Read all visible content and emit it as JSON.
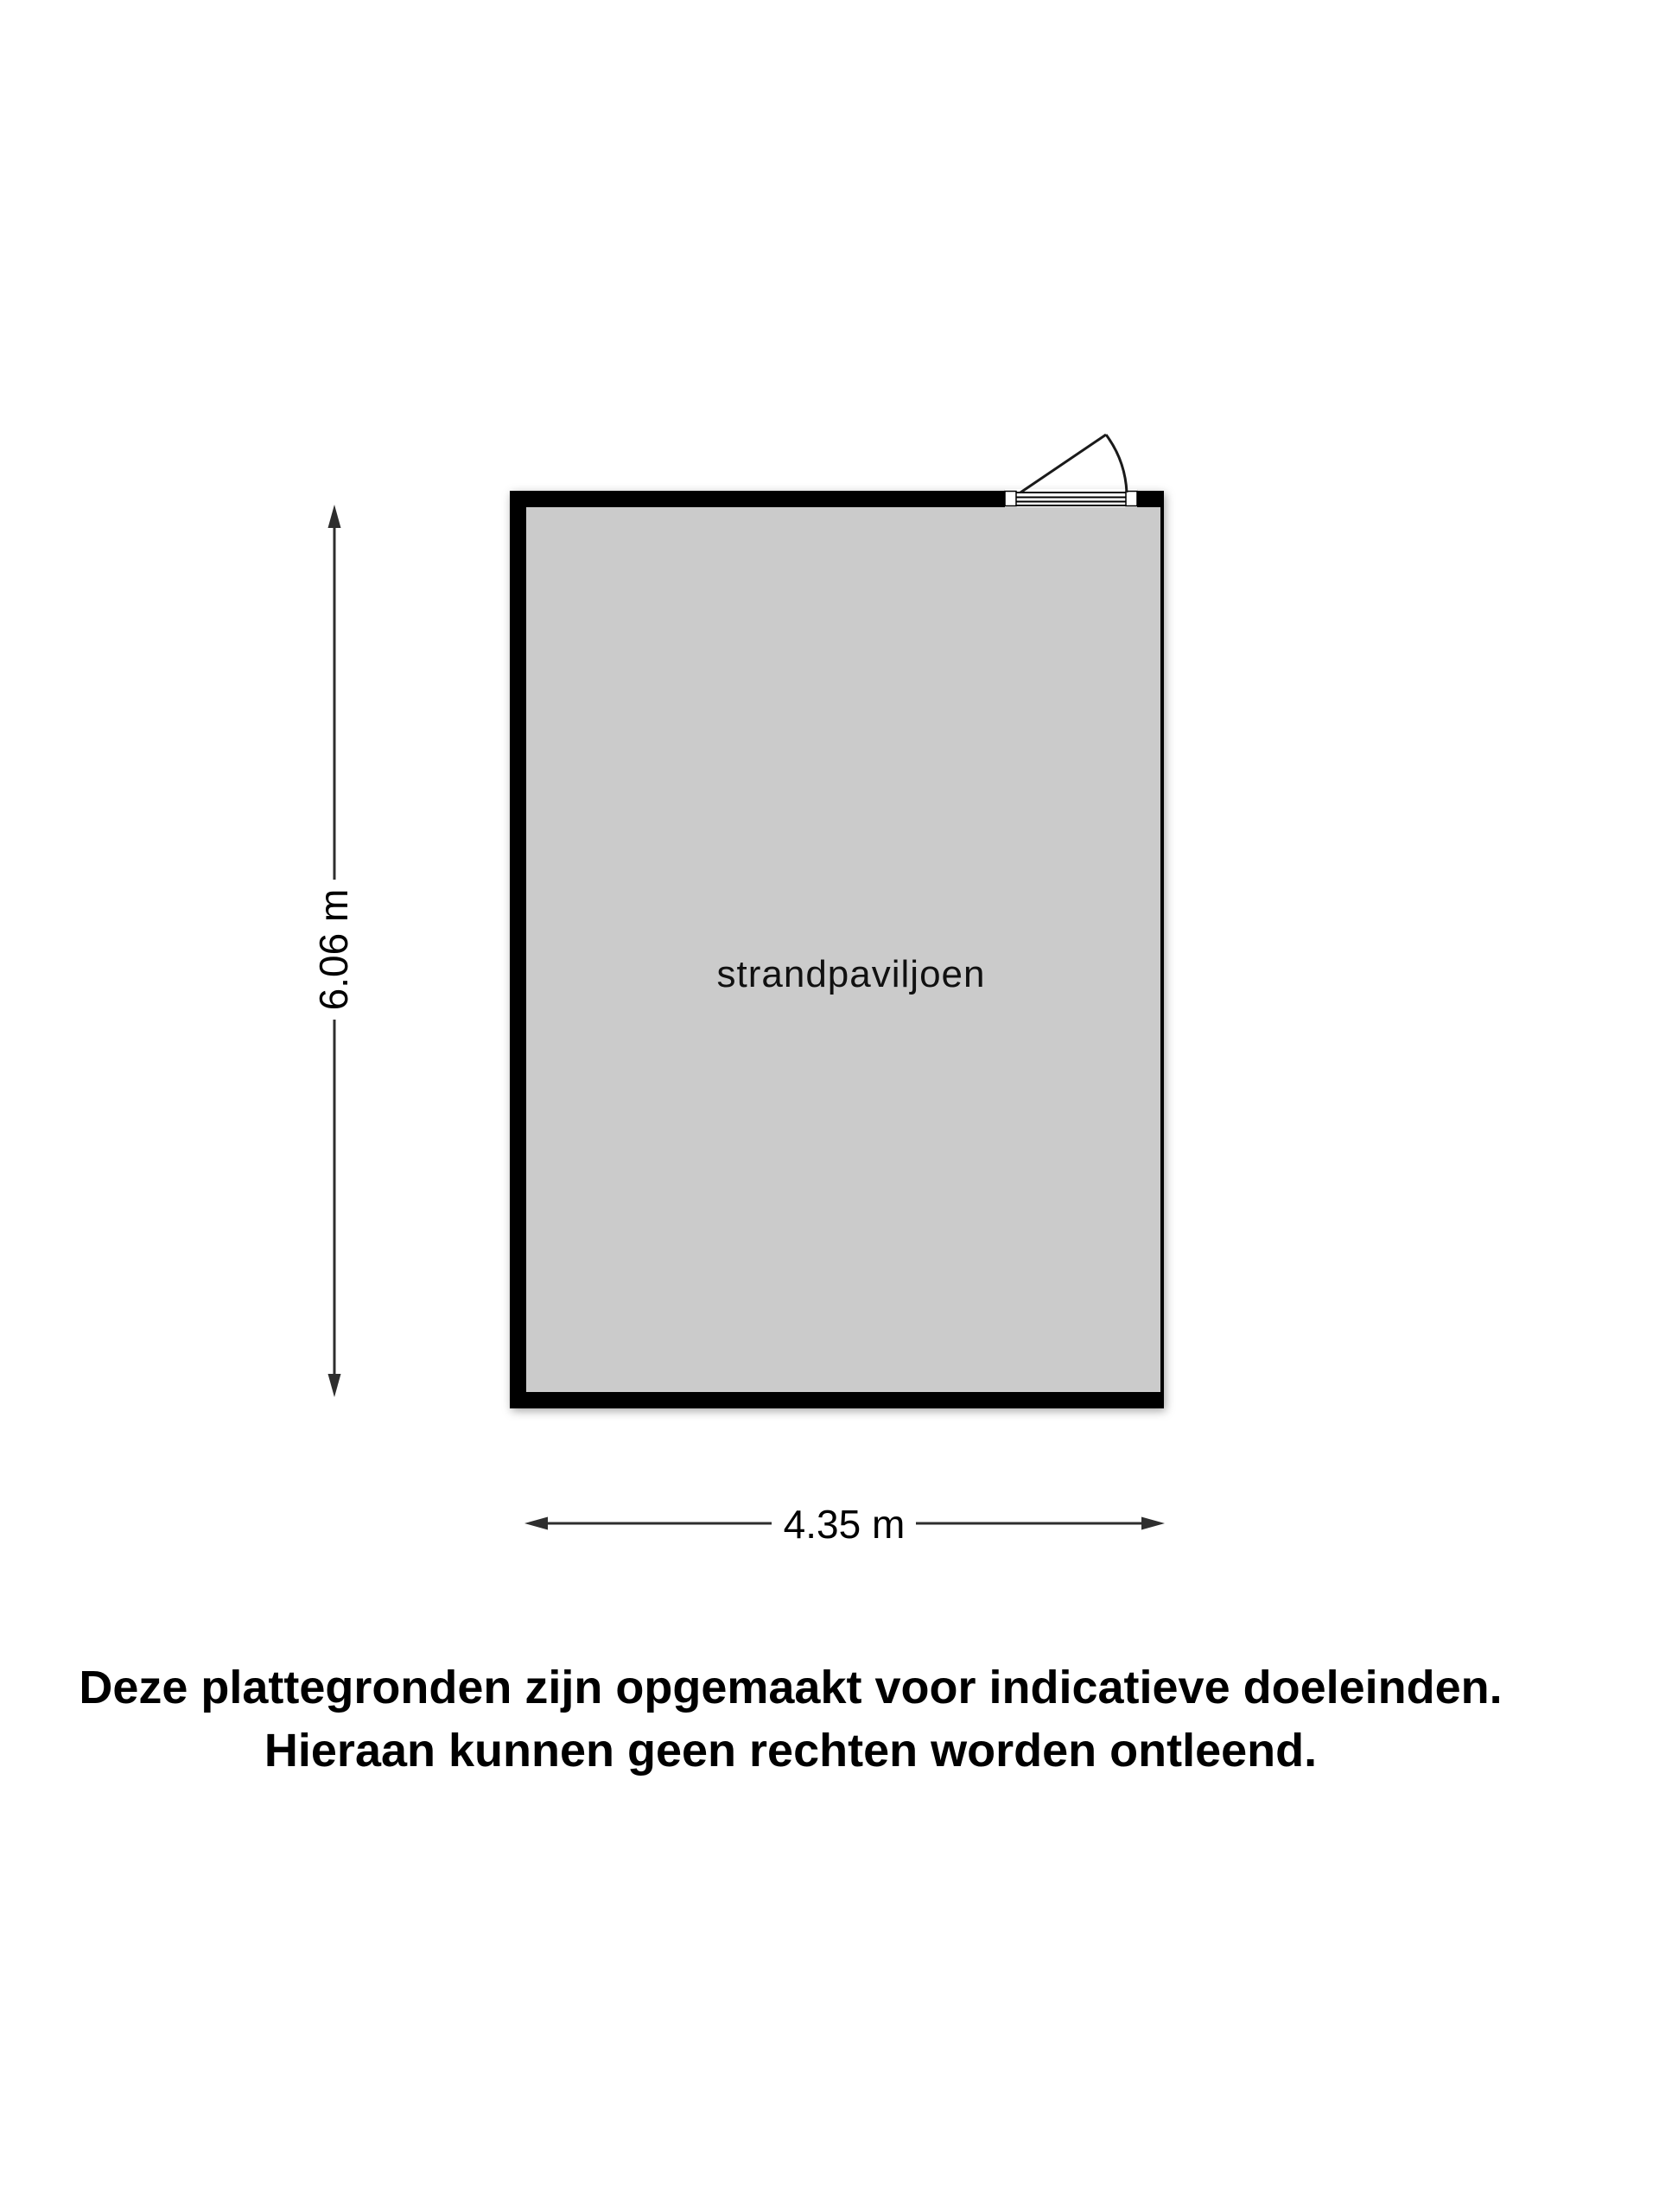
{
  "floor_plan": {
    "room": {
      "label": "strandpaviljoen"
    },
    "dimensions": {
      "height_label": "6.06 m",
      "width_label": "4.35 m"
    },
    "door": {
      "wall": "top",
      "hinge_side": "left",
      "swing": "outward"
    },
    "colors": {
      "background": "#ffffff",
      "room_fill": "#cbcbcb",
      "wall": "#000000",
      "dimension_line": "#2e2e2e",
      "text": "#000000"
    }
  },
  "disclaimer": {
    "line1": "Deze plattegronden zijn opgemaakt voor indicatieve doeleinden.",
    "line2": "Hieraan kunnen geen rechten worden ontleend."
  }
}
